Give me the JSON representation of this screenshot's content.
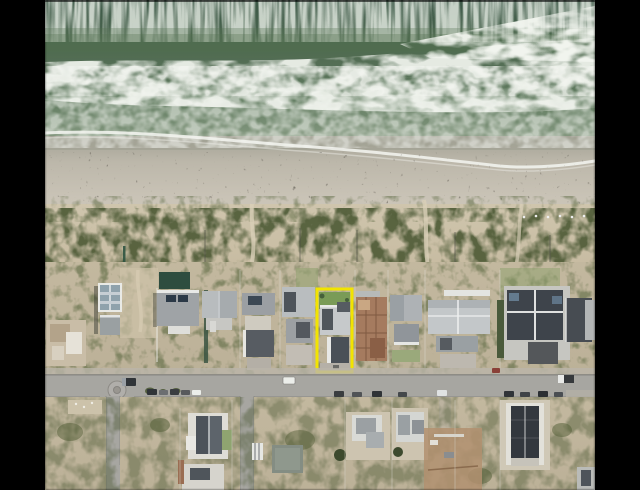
{
  "meta": {
    "type": "aerial-drone-photograph",
    "subject": "beachfront real-estate listing photo with highlighted erf",
    "no_visible_text": true
  },
  "scene": {
    "regions": [
      {
        "name": "ocean-surf",
        "desc": "green Atlantic water with white foam streaks at top"
      },
      {
        "name": "breaking-wave-band",
        "desc": "wide white foam band of breaking waves"
      },
      {
        "name": "swash-zone",
        "desc": "pale green water running up wet sand"
      },
      {
        "name": "sandy-beach",
        "desc": "wide light sand beach with footprints and kelp debris"
      },
      {
        "name": "dune-vegetation",
        "desc": "scrub-covered foredune with fence lines and sand paths"
      },
      {
        "name": "beachfront-houses",
        "desc": "row of beach houses with grey and slate roofs"
      },
      {
        "name": "highlighted-property",
        "desc": "erf outlined in yellow, house with slate roof and lawn"
      },
      {
        "name": "coastal-road",
        "desc": "tar road running parallel to beach with parked cars"
      },
      {
        "name": "mini-roundabout",
        "desc": "small traffic circle at left intersection"
      },
      {
        "name": "side-streets",
        "desc": "streets running inland from the coastal road"
      },
      {
        "name": "residential-area-south",
        "desc": "scrub erven, houses and construction sites below road"
      },
      {
        "name": "letterbox-bars",
        "desc": "black vertical bars left and right of photo"
      }
    ],
    "highlight": {
      "x": 317,
      "y": 289,
      "width": 35,
      "height": 83,
      "color": "#f2e400",
      "meaning": "boundary of the advertised property"
    }
  },
  "palette": {
    "letterbox": "#000000",
    "ocean-deep": "#3c5847",
    "ocean-mid": "#52704f",
    "ocean-light": "#7e937a",
    "foam": "#f2f5ef",
    "swash-line": "#f4f6f1",
    "wet-sand": "#a3a295",
    "beach-hi": "#cfc9bc",
    "dune-sand": "#c9bca1",
    "veg-dark": "#4d5a36",
    "scrub": "#c0b59c",
    "road": "#a7a6a1",
    "road-edge": "#878682",
    "roof-light": "#c6c9cb",
    "roof-mid": "#9aa0a3",
    "roof-dark": "#4a5057",
    "roof-white": "#e9eae6",
    "wall-white": "#e2e0d8",
    "brick": "#a57b5f",
    "lawn": "#7a9b57",
    "teal-wall": "#2e4d3f",
    "dirt": "#b29070",
    "slab": "#848d83",
    "car-dark": "#303438",
    "car-white": "#eceeea",
    "highlight": "#f2e400"
  }
}
